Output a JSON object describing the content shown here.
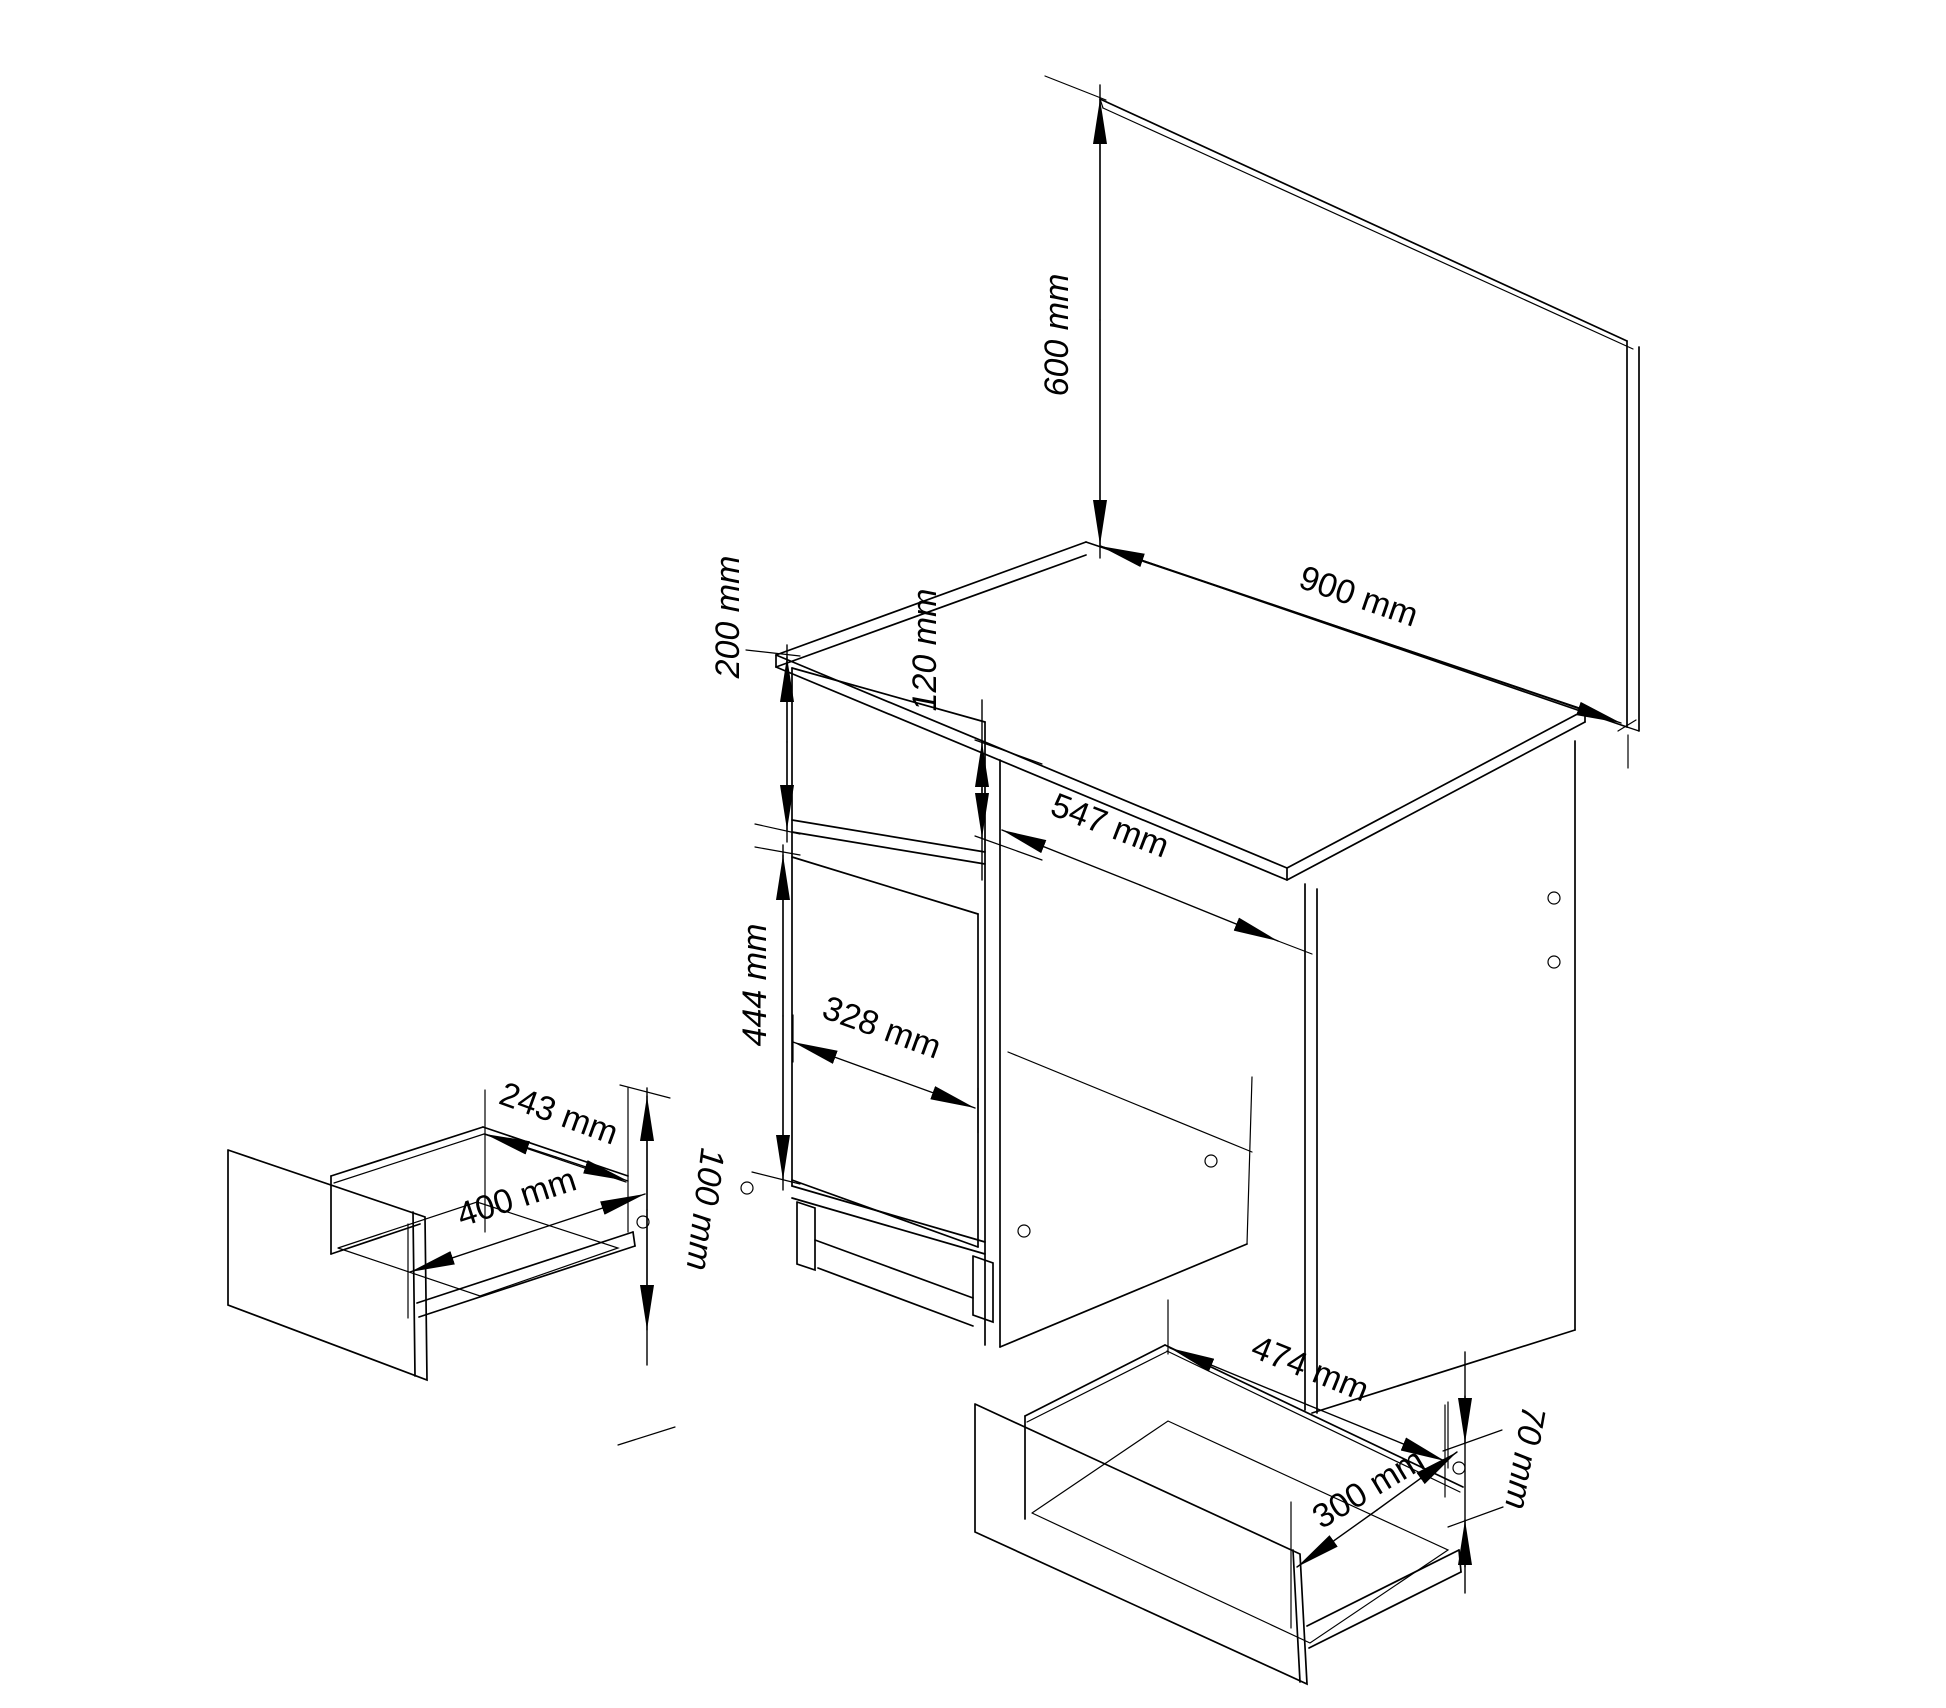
{
  "drawing": {
    "type": "furniture-technical-drawing",
    "unit": "mm",
    "dimensions": {
      "mirror_height": {
        "label": "600 mm",
        "value": 600
      },
      "mirror_width": {
        "label": "900 mm",
        "value": 900
      },
      "top_section_height": {
        "label": "200 mm",
        "value": 200
      },
      "drawer_front_height": {
        "label": "120 mm",
        "value": 120
      },
      "kneehole_width": {
        "label": "547 mm",
        "value": 547
      },
      "door_height": {
        "label": "444 mm",
        "value": 444
      },
      "door_width": {
        "label": "328 mm",
        "value": 328
      },
      "small_drawer_depth": {
        "label": "243 mm",
        "value": 243
      },
      "small_drawer_width": {
        "label": "400 mm",
        "value": 400
      },
      "small_drawer_height": {
        "label": "100 mm",
        "value": 100
      },
      "bottom_drawer_width": {
        "label": "474 mm",
        "value": 474
      },
      "bottom_drawer_depth": {
        "label": "300 mm",
        "value": 300
      },
      "bottom_drawer_height": {
        "label": "70 mm",
        "value": 70
      }
    },
    "colors": {
      "background": "#ffffff",
      "line": "#000000"
    }
  }
}
